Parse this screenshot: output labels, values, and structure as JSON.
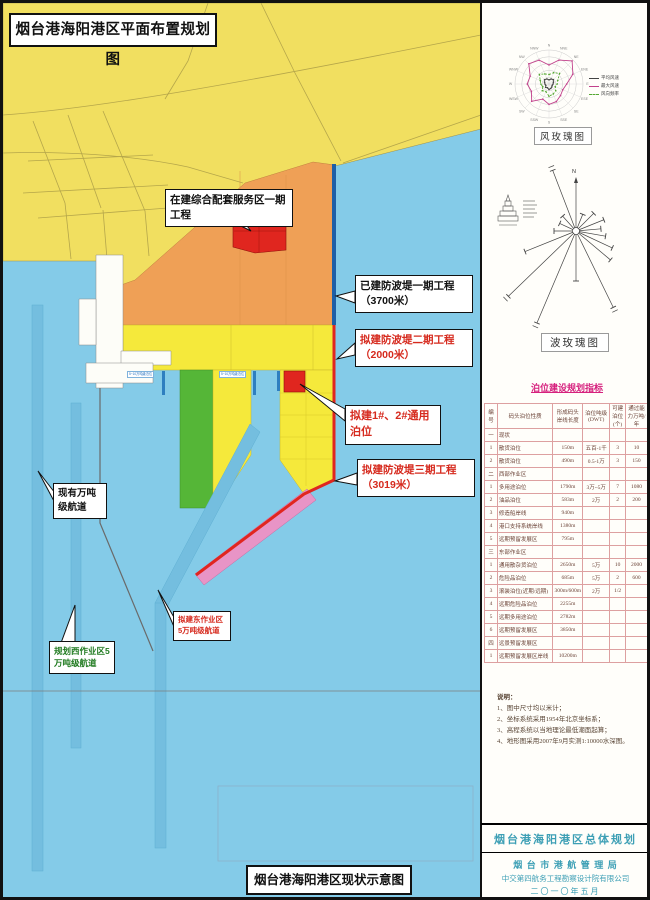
{
  "map": {
    "title": "烟台港海阳港区平面布置规划图",
    "bottom_box": "烟台港海阳港区现状示意图",
    "zones": {
      "harbor_service": "临港综合配套服务区",
      "general": "通用作业区",
      "container": "集装箱作业区",
      "support": "支持系统区",
      "roro": "滚装作业区",
      "red_block": "在建综合配套服务区一期"
    },
    "piers": {
      "west": "西突堤",
      "mid": "中突堤",
      "east": "东突堤"
    },
    "basins": {
      "west": "西港池",
      "mid": "中港池",
      "east": "东港池"
    },
    "breakwaters": {
      "p1": "防波堤一期3700米",
      "p2": "防波堤二期2000米",
      "p3": "防波堤三期3019米"
    },
    "berth_mark_label": "5~10万吨级泊位",
    "dims": [
      "1300",
      "880",
      "900",
      "900",
      "1080",
      "800"
    ],
    "callouts": {
      "under_construction": "在建综合配套服务区一期工程",
      "bw1": "已建防波堤一期工程（3700米）",
      "bw2": "拟建防波堤二期工程（2000米）",
      "berths12": "拟建1#、2#通用泊位",
      "bw3": "拟建防波堤三期工程（3019米）",
      "existing_channel": "现有万吨级航道",
      "east_channel": "拟建东作业区5万吨级航道",
      "west_channel": "规划西作业区5万吨级航道"
    }
  },
  "wind_rose": {
    "title": "风玫瑰图",
    "north_label": "N",
    "max": 25,
    "directions": [
      "N",
      "NNE",
      "NE",
      "ENE",
      "E",
      "ESE",
      "SE",
      "SSE",
      "S",
      "SSW",
      "SW",
      "WSW",
      "W",
      "WNW",
      "NW",
      "NNW"
    ],
    "series": [
      {
        "name": "平均风速",
        "color": "#444444",
        "dash": "",
        "values": [
          3,
          4,
          4.5,
          3.5,
          3,
          2.5,
          3,
          3.5,
          4,
          3,
          3.5,
          2.5,
          3,
          3.5,
          4.5,
          4
        ]
      },
      {
        "name": "最大风速",
        "color": "#C2418C",
        "dash": "",
        "values": [
          14,
          19,
          24,
          19,
          13,
          11,
          12,
          14,
          15,
          12,
          18,
          14,
          16,
          15,
          21,
          19
        ]
      },
      {
        "name": "风向频率",
        "color": "#55A832",
        "dash": "2,1.5",
        "values": [
          7,
          9,
          11,
          7,
          6,
          5,
          7,
          8,
          9,
          6,
          7,
          5,
          6,
          7,
          10,
          8
        ]
      }
    ]
  },
  "wave_rose": {
    "title": "波玫瑰图",
    "north_label": "N",
    "rays": [
      [
        0,
        50
      ],
      [
        22,
        18
      ],
      [
        45,
        25
      ],
      [
        68,
        30
      ],
      [
        85,
        25
      ],
      [
        100,
        30
      ],
      [
        115,
        40
      ],
      [
        130,
        45
      ],
      [
        154,
        85
      ],
      [
        180,
        50
      ],
      [
        203,
        100
      ],
      [
        226,
        94
      ],
      [
        248,
        55
      ],
      [
        270,
        22
      ],
      [
        295,
        18
      ],
      [
        318,
        20
      ],
      [
        339,
        65
      ]
    ]
  },
  "table": {
    "title": "泊位建设规划指标",
    "headers": [
      "编号",
      "码头泊位性质",
      "形成码头岸线长度",
      "泊位吨级(DWT)",
      "可建泊位(个)",
      "通过能力万吨/年"
    ],
    "rows": [
      [
        "一",
        "现状",
        "",
        "",
        "",
        ""
      ],
      [
        "1",
        "散货泊位",
        "150m",
        "五百-1千",
        "3",
        "10"
      ],
      [
        "2",
        "散货泊位",
        "490m",
        "0.5-1万",
        "3",
        "150"
      ],
      [
        "二",
        "西部作业区",
        "",
        "",
        "",
        ""
      ],
      [
        "1",
        "多用途泊位",
        "1790m",
        "3万~5万",
        "7",
        "1080"
      ],
      [
        "2",
        "油品泊位",
        "583m",
        "2万",
        "2",
        "200"
      ],
      [
        "3",
        "修造船岸线",
        "940m",
        "",
        "",
        ""
      ],
      [
        "4",
        "港口支持系统岸线",
        "1380m",
        "",
        "",
        ""
      ],
      [
        "5",
        "远期预留发展区",
        "795m",
        "",
        "",
        ""
      ],
      [
        "三",
        "东部作业区",
        "",
        "",
        "",
        ""
      ],
      [
        "1",
        "通用散杂货泊位",
        "2650m",
        "5万",
        "10",
        "2000"
      ],
      [
        "2",
        "危险品泊位",
        "685m",
        "5万",
        "2",
        "600"
      ],
      [
        "3",
        "滚装泊位(近期/远期)",
        "300m/600m",
        "2万",
        "1/2",
        ""
      ],
      [
        "4",
        "远期危险品泊位",
        "2255m",
        "",
        "",
        ""
      ],
      [
        "5",
        "远期多用途泊位",
        "2782m",
        "",
        "",
        ""
      ],
      [
        "6",
        "远期预留发展区",
        "3850m",
        "",
        "",
        ""
      ],
      [
        "四",
        "远景预留发展区",
        "",
        "",
        "",
        ""
      ],
      [
        "1",
        "远期预留发展区岸线",
        "10200m",
        "",
        "",
        ""
      ]
    ]
  },
  "notes": {
    "label": "说明：",
    "items": [
      "1、图中尺寸均以米计；",
      "2、坐标系统采用1954年北京坐标系；",
      "3、高程系统以当地理论最低潮面起算；",
      "4、地形图采用2007年9月实测1:10000水深图。"
    ]
  },
  "title_block": {
    "plan_title": "烟台港海阳港区总体规划",
    "org1": "烟 台 市 港 航 管 理 局",
    "org2": "中交第四航务工程勘察设计院有限公司",
    "date": "二〇一〇年五月"
  },
  "colors": {
    "sea": "#84CBE8",
    "land": "#F1DF60",
    "orange_zone": "#EFA056",
    "work_yellow": "#F5E93B",
    "container_green": "#55B637",
    "breakwater3_pink": "#E894C6",
    "red": "#E0261F",
    "breakwater1_navy": "#1E5FA6",
    "channel": "#74BEDF",
    "title_teal": "#3D9FB5",
    "table_magenta": "#D6217E"
  }
}
